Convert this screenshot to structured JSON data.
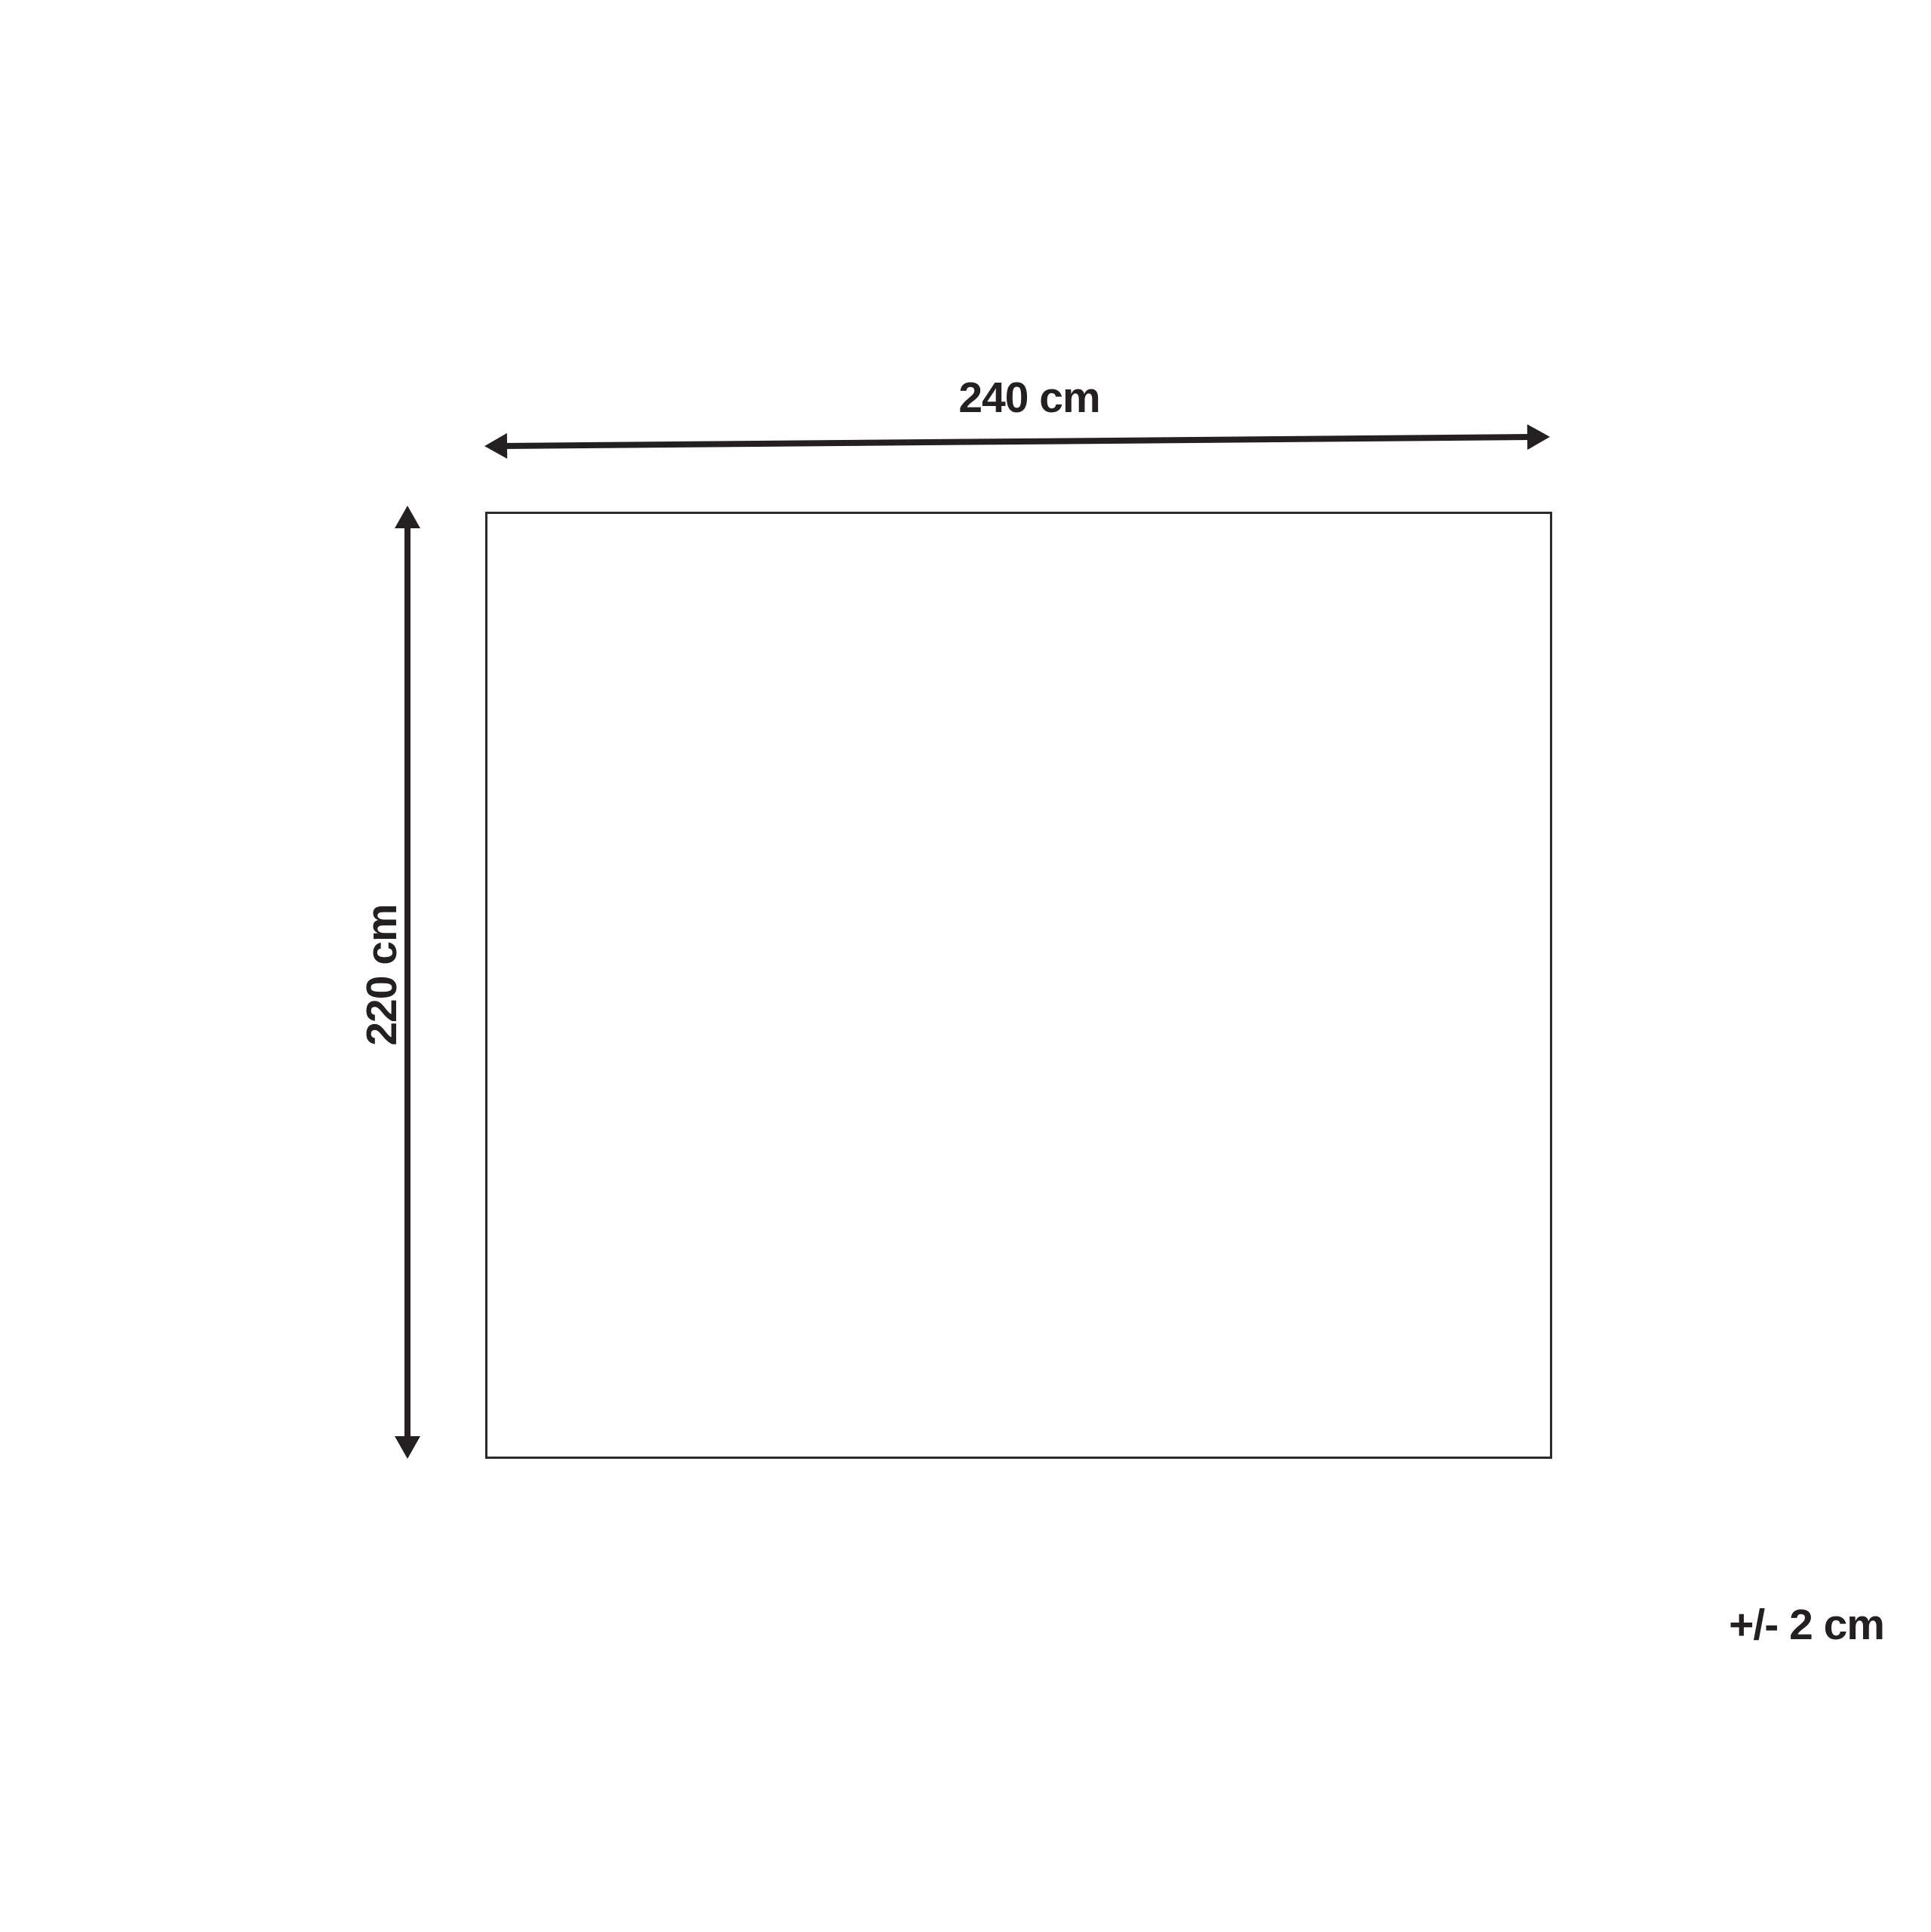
{
  "diagram": {
    "type": "product-dimension-diagram",
    "shape": "rectangle",
    "width": {
      "value": 240,
      "unit": "cm",
      "label": "240 cm"
    },
    "height": {
      "value": 220,
      "unit": "cm",
      "label": "220 cm"
    },
    "tolerance": {
      "value": 2,
      "unit": "cm",
      "label": "+/- 2 cm"
    },
    "colors": {
      "ink": "#242021",
      "outline": "#2d2a2b",
      "background": "#ffffff"
    }
  }
}
